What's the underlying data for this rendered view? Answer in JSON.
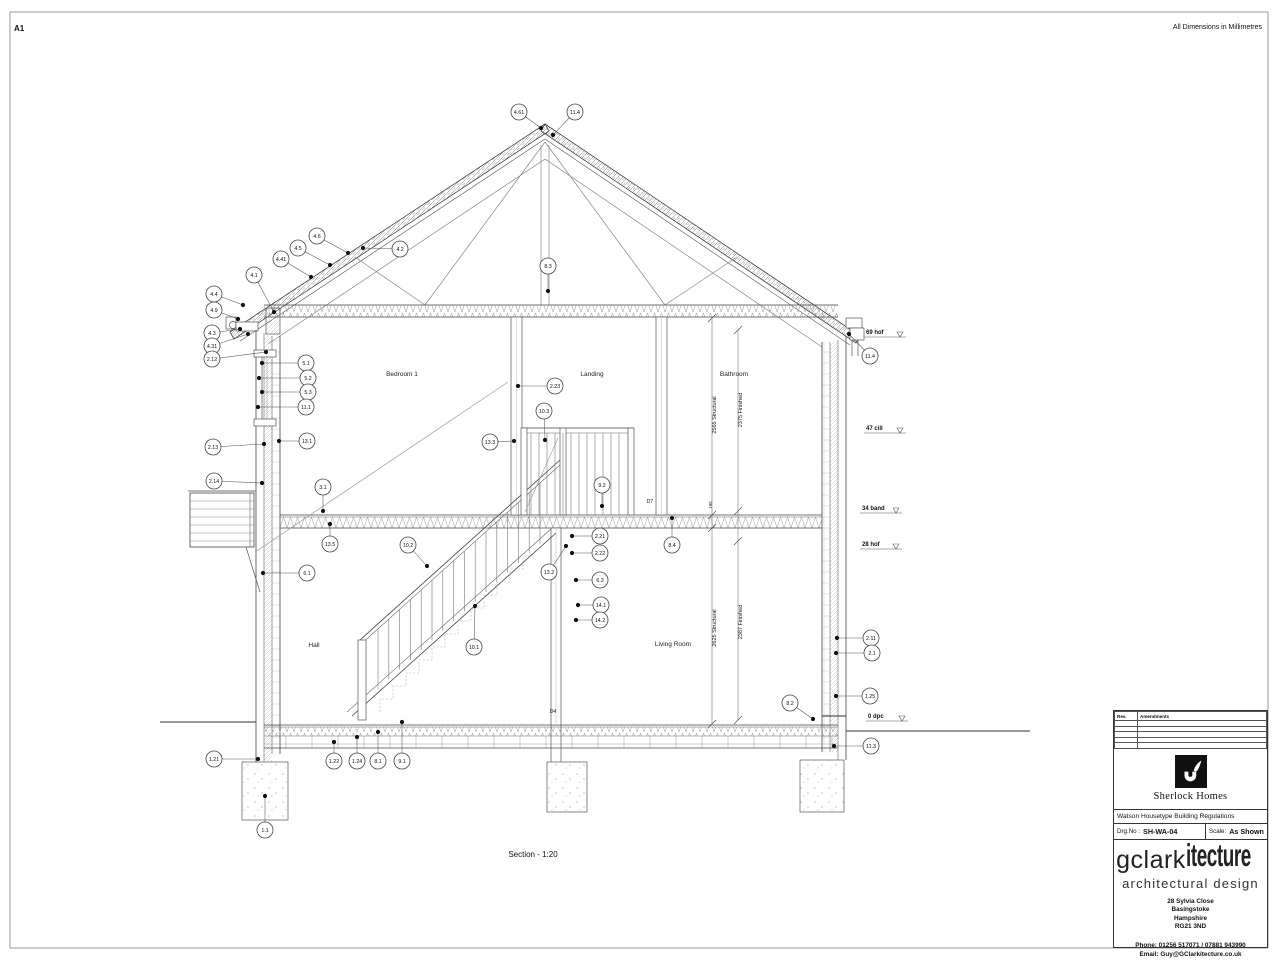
{
  "page": {
    "sheet_size": "A1",
    "dimension_note": "All Dimensions in Millimetres",
    "caption": "Section - 1:20"
  },
  "drawing": {
    "rooms": [
      {
        "label": "Bedroom 1",
        "x": 402,
        "y": 376
      },
      {
        "label": "Landing",
        "x": 592,
        "y": 376
      },
      {
        "label": "Bathroom",
        "x": 734,
        "y": 376
      },
      {
        "label": "Hall",
        "x": 314,
        "y": 647
      },
      {
        "label": "Living Room",
        "x": 673,
        "y": 646
      }
    ],
    "callouts": [
      {
        "label": "4.61",
        "cx": 519,
        "cy": 112,
        "dx": 541,
        "dy": 128
      },
      {
        "label": "11.4",
        "cx": 575,
        "cy": 112,
        "dx": 553,
        "dy": 135
      },
      {
        "label": "8.3",
        "cx": 548,
        "cy": 266,
        "dx": 548,
        "dy": 291
      },
      {
        "label": "4.6",
        "cx": 317,
        "cy": 236,
        "dx": 348,
        "dy": 253
      },
      {
        "label": "4.5",
        "cx": 298,
        "cy": 248,
        "dx": 330,
        "dy": 265
      },
      {
        "label": "4.41",
        "cx": 281,
        "cy": 259,
        "dx": 311,
        "dy": 277
      },
      {
        "label": "4.1",
        "cx": 254,
        "cy": 275,
        "dx": 274,
        "dy": 312
      },
      {
        "label": "4.2",
        "cx": 400,
        "cy": 249,
        "dx": 363,
        "dy": 248
      },
      {
        "label": "4.4",
        "cx": 214,
        "cy": 294,
        "dx": 243,
        "dy": 305
      },
      {
        "label": "4.9",
        "cx": 214,
        "cy": 310,
        "dx": 238,
        "dy": 319
      },
      {
        "label": "4.3",
        "cx": 212,
        "cy": 333,
        "dx": 240,
        "dy": 329
      },
      {
        "label": "4.31",
        "cx": 212,
        "cy": 346,
        "dx": 248,
        "dy": 334
      },
      {
        "label": "2.12",
        "cx": 212,
        "cy": 359,
        "dx": 266,
        "dy": 352
      },
      {
        "label": "5.1",
        "cx": 306,
        "cy": 363,
        "dx": 262,
        "dy": 363
      },
      {
        "label": "5.2",
        "cx": 308,
        "cy": 378,
        "dx": 259,
        "dy": 378
      },
      {
        "label": "5.3",
        "cx": 308,
        "cy": 392,
        "dx": 262,
        "dy": 392
      },
      {
        "label": "11.1",
        "cx": 306,
        "cy": 407,
        "dx": 258,
        "dy": 407
      },
      {
        "label": "13.1",
        "cx": 307,
        "cy": 441,
        "dx": 279,
        "dy": 441
      },
      {
        "label": "2.13",
        "cx": 213,
        "cy": 447,
        "dx": 264,
        "dy": 444
      },
      {
        "label": "2.14",
        "cx": 214,
        "cy": 481,
        "dx": 262,
        "dy": 483
      },
      {
        "label": "6.1",
        "cx": 307,
        "cy": 573,
        "dx": 263,
        "dy": 573
      },
      {
        "label": "1.21",
        "cx": 214,
        "cy": 759,
        "dx": 258,
        "dy": 759
      },
      {
        "label": "1.1",
        "cx": 265,
        "cy": 830,
        "dx": 265,
        "dy": 796
      },
      {
        "label": "2.23",
        "cx": 555,
        "cy": 386,
        "dx": 518,
        "dy": 386
      },
      {
        "label": "10.3",
        "cx": 544,
        "cy": 411,
        "dx": 545,
        "dy": 440
      },
      {
        "label": "13.3",
        "cx": 490,
        "cy": 442,
        "dx": 514,
        "dy": 441
      },
      {
        "label": "3.1",
        "cx": 323,
        "cy": 487,
        "dx": 323,
        "dy": 511
      },
      {
        "label": "13.5",
        "cx": 330,
        "cy": 544,
        "dx": 330,
        "dy": 524
      },
      {
        "label": "9.2",
        "cx": 602,
        "cy": 485,
        "dx": 602,
        "dy": 506
      },
      {
        "label": "8.4",
        "cx": 672,
        "cy": 545,
        "dx": 672,
        "dy": 518
      },
      {
        "label": "2.21",
        "cx": 600,
        "cy": 536,
        "dx": 572,
        "dy": 536
      },
      {
        "label": "2.22",
        "cx": 600,
        "cy": 553,
        "dx": 572,
        "dy": 553
      },
      {
        "label": "13.2",
        "cx": 549,
        "cy": 572,
        "dx": 566,
        "dy": 546
      },
      {
        "label": "6.3",
        "cx": 600,
        "cy": 580,
        "dx": 576,
        "dy": 580
      },
      {
        "label": "14.1",
        "cx": 601,
        "cy": 605,
        "dx": 578,
        "dy": 605
      },
      {
        "label": "14.2",
        "cx": 600,
        "cy": 620,
        "dx": 576,
        "dy": 620
      },
      {
        "label": "10.2",
        "cx": 408,
        "cy": 545,
        "dx": 427,
        "dy": 566
      },
      {
        "label": "10.1",
        "cx": 474,
        "cy": 647,
        "dx": 475,
        "dy": 606
      },
      {
        "label": "11.4",
        "cx": 870,
        "cy": 356,
        "dx": 849,
        "dy": 334
      },
      {
        "label": "2.11",
        "cx": 871,
        "cy": 638,
        "dx": 837,
        "dy": 638
      },
      {
        "label": "2.1",
        "cx": 872,
        "cy": 653,
        "dx": 836,
        "dy": 653
      },
      {
        "label": "1.25",
        "cx": 870,
        "cy": 696,
        "dx": 836,
        "dy": 696
      },
      {
        "label": "11.3",
        "cx": 871,
        "cy": 746,
        "dx": 834,
        "dy": 746
      },
      {
        "label": "8.2",
        "cx": 790,
        "cy": 703,
        "dx": 813,
        "dy": 719
      },
      {
        "label": "1.22",
        "cx": 334,
        "cy": 761,
        "dx": 334,
        "dy": 742
      },
      {
        "label": "1.24",
        "cx": 357,
        "cy": 761,
        "dx": 357,
        "dy": 737
      },
      {
        "label": "8.1",
        "cx": 378,
        "cy": 761,
        "dx": 378,
        "dy": 732
      },
      {
        "label": "9.1",
        "cx": 402,
        "cy": 761,
        "dx": 402,
        "dy": 722
      }
    ],
    "levels": [
      {
        "label": "69 hof",
        "x": 866,
        "y": 332
      },
      {
        "label": "47 cill",
        "x": 866,
        "y": 428
      },
      {
        "label": "34 band",
        "x": 862,
        "y": 508
      },
      {
        "label": "28 hof",
        "x": 862,
        "y": 544
      },
      {
        "label": "0 dpc",
        "x": 868,
        "y": 716
      }
    ],
    "dims": [
      {
        "label": "2565 Structural",
        "x": 716,
        "y": 415,
        "small": false
      },
      {
        "label": "2375 Finished",
        "x": 742,
        "y": 410,
        "small": false
      },
      {
        "label": "2625 Structural",
        "x": 716,
        "y": 628,
        "small": false
      },
      {
        "label": "2387 Finished",
        "x": 742,
        "y": 622,
        "small": false
      },
      {
        "label": "195",
        "x": 712,
        "y": 505,
        "small": true
      }
    ],
    "door_refs": [
      {
        "label": "D7",
        "x": 650,
        "y": 503
      },
      {
        "label": "D4",
        "x": 553,
        "y": 713
      }
    ]
  },
  "title_block": {
    "rev_header": "Rev.",
    "amendments_header": "Amendments",
    "company_name": "Sherlock Homes",
    "project_title": "Watson Housetype Building Regulations",
    "drg_no_label": "Drg.No :",
    "drg_no": "SH-WA-04",
    "scale_label": "Scale:",
    "scale": "As Shown",
    "brand_primary": "gclark",
    "brand_secondary": "itecture",
    "brand_tagline": "architectural design",
    "address_lines": [
      "28 Sylvia Close",
      "Basingstoke",
      "Hampshire",
      "RG21 3ND"
    ],
    "phone": "Phone: 01256 517071 / 07881 943990",
    "email": "Email: Guy@GClarkitecture.co.uk"
  }
}
